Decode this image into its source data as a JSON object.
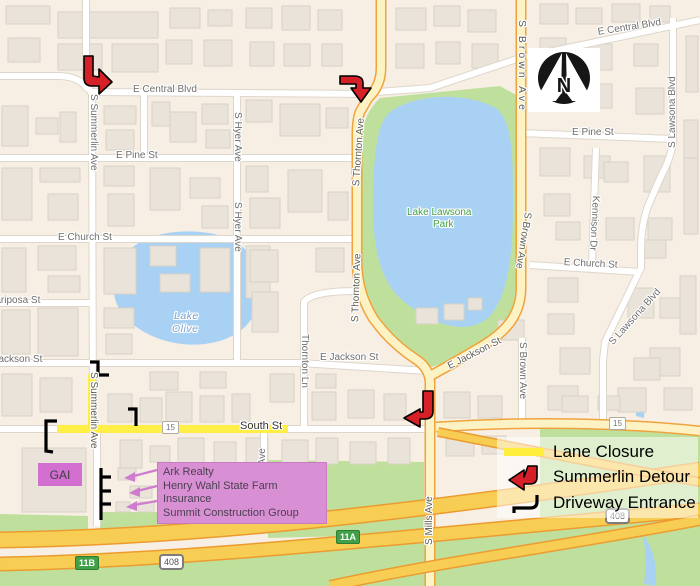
{
  "map": {
    "streets": [
      {
        "name": "E Central Blvd"
      },
      {
        "name": "E Central Blvd"
      },
      {
        "name": "E Pine St"
      },
      {
        "name": "E Pine St"
      },
      {
        "name": "E Church St"
      },
      {
        "name": "E Church St"
      },
      {
        "name": "Mariposa St"
      },
      {
        "name": "E Jackson St"
      },
      {
        "name": "E Jackson St"
      },
      {
        "name": "E Jackson St"
      },
      {
        "name": "S Summerlin Ave"
      },
      {
        "name": "S Summerlin Ave"
      },
      {
        "name": "S Hyer Ave"
      },
      {
        "name": "S Hyer Ave"
      },
      {
        "name": "S Hyer Ave"
      },
      {
        "name": "S Thornton Ave"
      },
      {
        "name": "S Thornton Ave"
      },
      {
        "name": "Thornton Ln"
      },
      {
        "name": "S Brown Ave"
      },
      {
        "name": "S Brown Ave"
      },
      {
        "name": "S Brown Ave"
      },
      {
        "name": "S Lawsona Blvd"
      },
      {
        "name": "S Lawsona Blvd"
      },
      {
        "name": "Kennison Dr"
      },
      {
        "name": "S Mills Ave"
      },
      {
        "name": "South St"
      }
    ],
    "water_labels": [
      {
        "text": "Lake"
      },
      {
        "text": "Olive"
      }
    ],
    "park_labels": [
      {
        "text": "Lake Lawsona"
      },
      {
        "text": "Park"
      }
    ],
    "shields": [
      {
        "text": "15"
      },
      {
        "text": "15"
      },
      {
        "text": "408"
      },
      {
        "text": "408"
      },
      {
        "text": "11A"
      },
      {
        "text": "11B"
      }
    ],
    "compass": {
      "letter": "N"
    }
  },
  "legend": {
    "items": [
      {
        "label": "Lane Closure"
      },
      {
        "label": "Summerlin Detour"
      },
      {
        "label": "Driveway Entrance"
      }
    ]
  },
  "callout": {
    "building_label": "GAI",
    "lines": [
      {
        "text": "Ark Realty"
      },
      {
        "text": "Henry Wahl State Farm Insurance"
      },
      {
        "text": "Summit Construction Group"
      }
    ]
  },
  "colors": {
    "lane-closure": "#FFEE3C",
    "detour-red": "#D62027",
    "driveway-black": "#000000",
    "callout-pink": "#D98FD3",
    "gai-magenta": "#D26FD0",
    "water": "#A9D1F4",
    "park": "#BFE09C",
    "highway-gold": "#F7CE53",
    "shield-green": "#41A048"
  }
}
